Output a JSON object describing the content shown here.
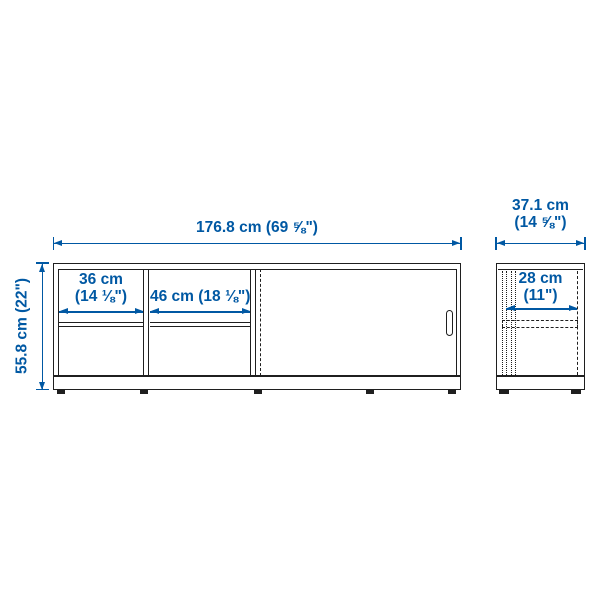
{
  "colors": {
    "accent": "#0058a3",
    "line": "#1f1f1f",
    "background": "#ffffff"
  },
  "front_view": {
    "overall_width_label": "176.8 cm (69 ⅝\")",
    "overall_height_label": "55.8 cm (22\")",
    "left_compartment_width": {
      "line1": "36 cm",
      "line2": "(14 ⅛\")"
    },
    "middle_compartment_width_label": "46 cm (18 ⅛\")"
  },
  "side_view": {
    "overall_depth": {
      "line1": "37.1 cm",
      "line2": "(14 ⅝\")"
    },
    "inner_depth": {
      "line1": "28 cm",
      "line2": "(11\")"
    }
  }
}
